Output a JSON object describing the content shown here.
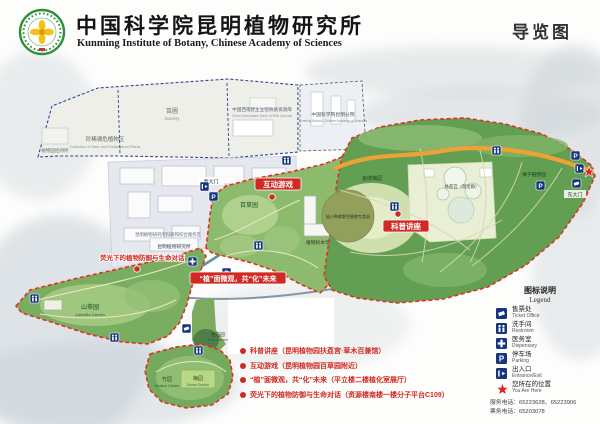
{
  "header": {
    "org_cn": "中国科学院昆明植物研究所",
    "org_en": "Kunming Institute of Botany, Chinese Academy of Sciences",
    "map_title": "导览图"
  },
  "map": {
    "areas": {
      "rare": {
        "cn": "珍稀濒危植物区",
        "en": "Collection of Rare and Endangered Plants"
      },
      "nursery": {
        "cn": "苗圃",
        "en": "Nursery"
      },
      "germplasm": {
        "cn": "中国西南野生生物种质资源库",
        "en": "China Germplasm Bank of Wild Species"
      },
      "branch": {
        "cn": "中国科学院昆明分院",
        "en": "Kunming Branch, Chinese Academy of Sciences"
      },
      "hostel": {
        "cn": "植物园招待所"
      },
      "campus": {
        "cn": "昆明植物研究所科研和综合服务区"
      },
      "kib_building": {
        "cn": "昆明植物研究所"
      },
      "camellia": {
        "cn": "山茶园",
        "en": "Camellia Garden"
      },
      "herb": {
        "cn": "百草园"
      },
      "herbarium": {
        "cn": "植物标本馆"
      },
      "hamamelis": {
        "cn": "金缕梅园"
      },
      "greenhouse": {
        "cn": "扶荔宫（温室群）"
      },
      "smallpop": {
        "cn": "极小种群野生植物专类园"
      },
      "gymnosperm": {
        "cn": "裸子植物园"
      },
      "rock": {
        "cn": "岩石园",
        "en": "Rock Garden"
      },
      "bamboo": {
        "cn": "竹园",
        "en": "Bamboo Garden"
      },
      "mume": {
        "cn": "梅园",
        "en": "Mume Garden"
      }
    },
    "gates": {
      "west": "西大门",
      "east": "东大门"
    },
    "events": {
      "game": "互动游戏",
      "lecture": "科普讲座",
      "fluorescence": "荧光下的植物防御与生命对话",
      "phyto": "“植”面微观，共“化”未来"
    },
    "glyphs": {
      "parking": "P"
    }
  },
  "legend": {
    "title_cn": "图标说明",
    "title_en": "Legend",
    "items": [
      {
        "cn": "售票处",
        "en": "Ticket Office"
      },
      {
        "cn": "洗手间",
        "en": "Restroom"
      },
      {
        "cn": "医务室",
        "en": "Dispensary"
      },
      {
        "cn": "停车场",
        "en": "Parking"
      },
      {
        "cn": "出入口",
        "en": "Entrance/Exit"
      },
      {
        "cn": "您所在的位置",
        "en": "You Are Here"
      }
    ],
    "phone1": "服务电话：65223628、65223906",
    "phone2": "票务电话：65203078"
  },
  "notes": {
    "items": [
      "科普讲座（昆明植物园扶荔宫·草木百兼馆）",
      "互动游戏（昆明植物园百草园附近）",
      "“植”面微观，共“化”未来（平立楼二楼植化室展厅）",
      "荧光下的植物防御与生命对话（资源楼南楼一楼分子平台C109）"
    ]
  },
  "colors": {
    "boundary_red": "#e23026",
    "boundary_blue": "#31449b",
    "road_orange": "#f0a135",
    "icon_blue": "#16357d",
    "garden_green": "#79ae61",
    "event_red": "#cf2a24"
  }
}
